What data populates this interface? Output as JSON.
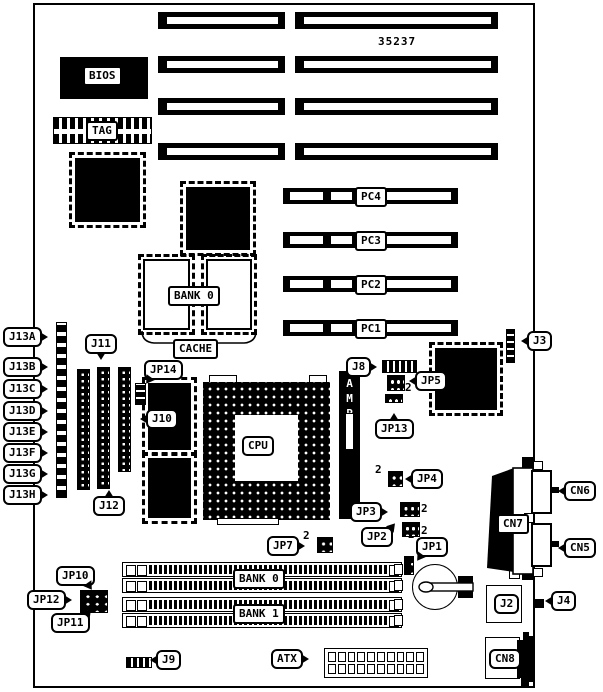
{
  "board": {
    "part_number": "35237"
  },
  "labels": {
    "bios": "BIOS",
    "tag": "TAG",
    "bank0_cache": "BANK 0",
    "cache": "CACHE",
    "cpu": "CPU",
    "amp": "AMP",
    "pc4": "PC4",
    "pc3": "PC3",
    "pc2": "PC2",
    "pc1": "PC1",
    "j13a": "J13A",
    "j13b": "J13B",
    "j13c": "J13C",
    "j13d": "J13D",
    "j13e": "J13E",
    "j13f": "J13F",
    "j13g": "J13G",
    "j13h": "J13H",
    "j11": "J11",
    "j12": "J12",
    "j10": "J10",
    "jp14": "JP14",
    "j8": "J8",
    "jp5": "JP5",
    "jp13": "JP13",
    "jp4": "JP4",
    "jp3": "JP3",
    "jp2": "JP2",
    "jp7": "JP7",
    "jp1": "JP1",
    "jp10": "JP10",
    "jp12": "JP12",
    "jp11": "JP11",
    "j9": "J9",
    "atx": "ATX",
    "j3": "J3",
    "cn6": "CN6",
    "cn7": "CN7",
    "cn5": "CN5",
    "j2": "J2",
    "j4": "J4",
    "cn8": "CN8",
    "bank0_mem": "BANK 0",
    "bank1_mem": "BANK 1",
    "pin2_marker": "2"
  }
}
